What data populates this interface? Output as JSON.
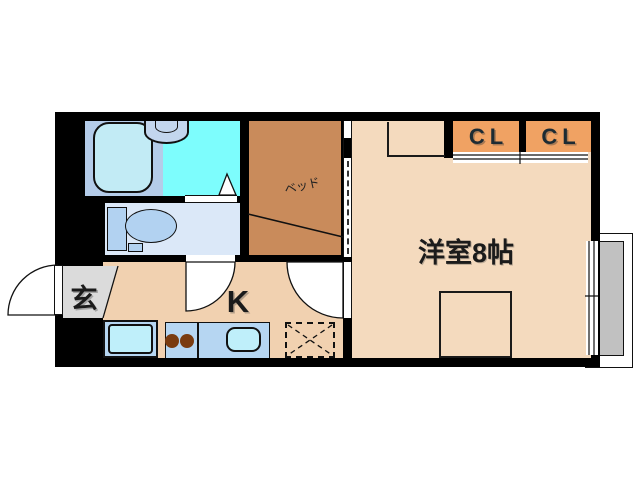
{
  "floor_plan": {
    "rooms": {
      "entrance": {
        "label": "玄"
      },
      "kitchen": {
        "label": "K"
      },
      "western_room": {
        "label": "洋室8帖"
      },
      "bed_space": {
        "label": "ベッド"
      },
      "closet_left": {
        "label": "CL"
      },
      "closet_right": {
        "label": "CL"
      }
    },
    "colors": {
      "wall": "#000000",
      "western_room_floor": "#f4dabe",
      "kitchen_floor": "#f1d1b0",
      "bed_space": "#c98b5b",
      "closet": "#f0a263",
      "entrance_floor": "#dbdbdb",
      "balcony_floor": "#c1c1c1",
      "bathroom_floor": "#b4cce9",
      "bathtub": "#c2ebf5",
      "shower_area": "#7dfdfd",
      "toilet_room_floor": "#dbe8f8",
      "toilet_fixture": "#b2d2f1",
      "kitchen_counter": "#b6d6f2",
      "sink_basin": "#bfeffa",
      "stove_burner": "#7a3b10",
      "label_text": "#1b1b1b"
    }
  }
}
